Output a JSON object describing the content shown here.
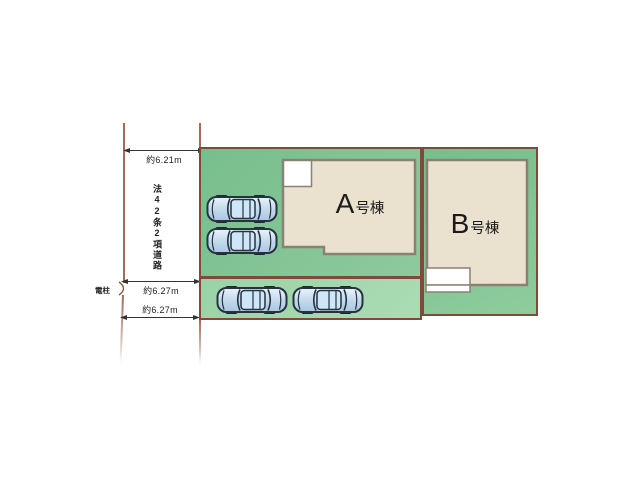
{
  "title": "site-plan",
  "road": {
    "label": "法42条2項道路",
    "pole_label": "電柱"
  },
  "dimensions": {
    "top": "約6.21m",
    "middle": "約6.27m",
    "bottom": "約6.27m"
  },
  "buildings": {
    "a": {
      "letter": "A",
      "suffix": "号棟"
    },
    "b": {
      "letter": "B",
      "suffix": "号棟"
    }
  },
  "cars": {
    "count": 4
  },
  "colors": {
    "plot_green": "#78be8c",
    "parking_strip_green": "#9bd2a6",
    "boundary_line": "#7d4a3c",
    "road_line": "#a26b58",
    "building_fill": "#eae1cf",
    "building_outline": "#8b8173",
    "car_body": "#cfe3f2",
    "car_outline": "#26323e",
    "dimension_text": "#222222"
  }
}
